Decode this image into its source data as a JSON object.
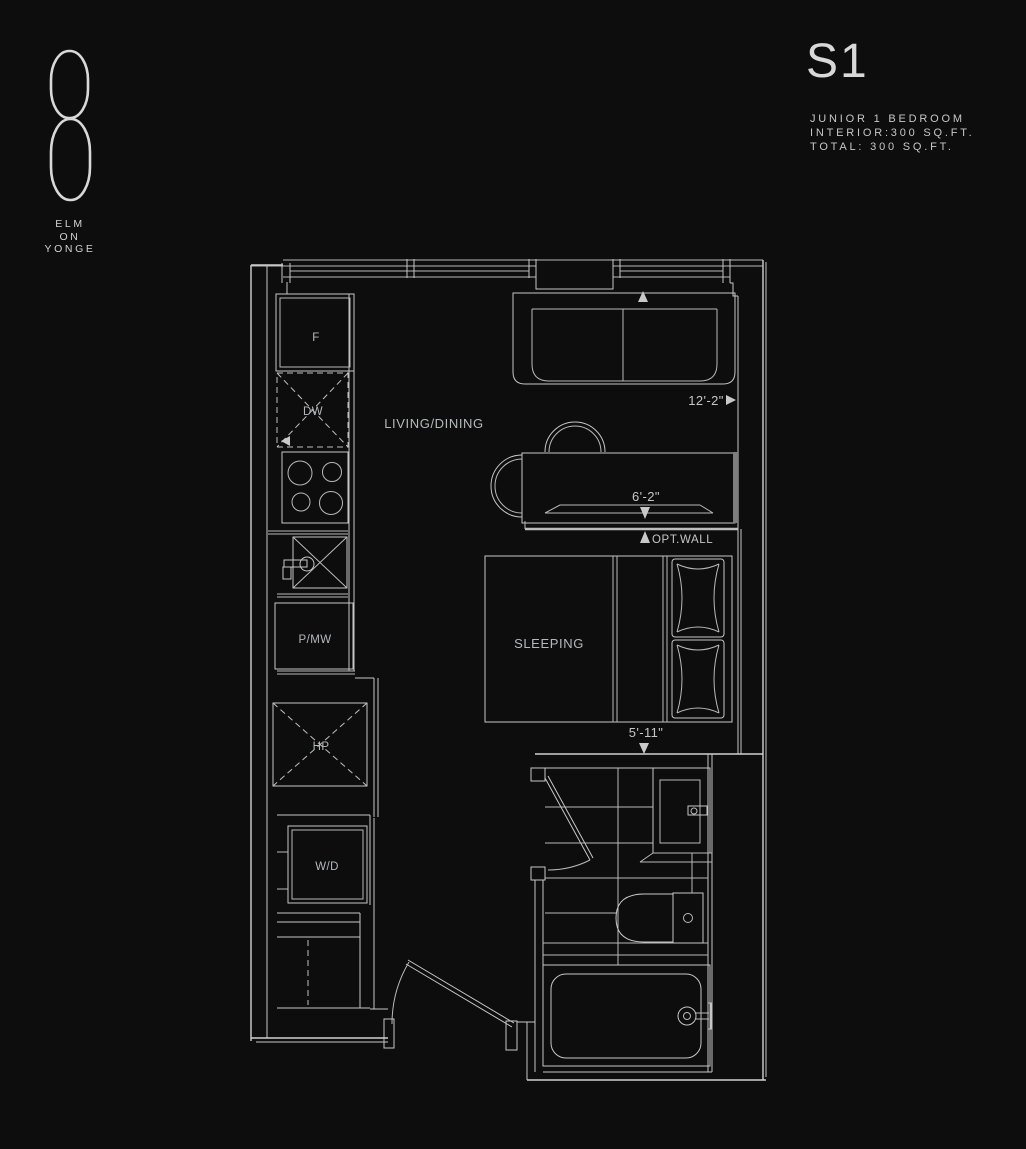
{
  "logo": {
    "line1": "ELM",
    "line2": "ON",
    "line3": "YONGE"
  },
  "header": {
    "plan_code": "S1",
    "unit_type": "JUNIOR 1 BEDROOM",
    "interior_area": "INTERIOR:300 SQ.FT.",
    "total_area": "TOTAL: 300 SQ.FT."
  },
  "plan": {
    "rooms": {
      "living_dining": "LIVING/DINING",
      "sleeping": "SLEEPING"
    },
    "appliances": {
      "fridge": "F",
      "dishwasher": "DW",
      "pantry_microwave": "P/MW",
      "heat_pump": "HP",
      "washer_dryer": "W/D"
    },
    "dimensions": {
      "living_width": "12'-2\"",
      "table_width": "6'-2\"",
      "bed_width": "5'-11\""
    },
    "annotations": {
      "optional_wall": "OPT.WALL"
    }
  },
  "colors": {
    "background": "#0d0d0d",
    "line": "#c6c6c6",
    "wall": "#d2d2d2",
    "label_text": "#b5b9bb",
    "optional_wall_fill": "#7d7d7d"
  }
}
